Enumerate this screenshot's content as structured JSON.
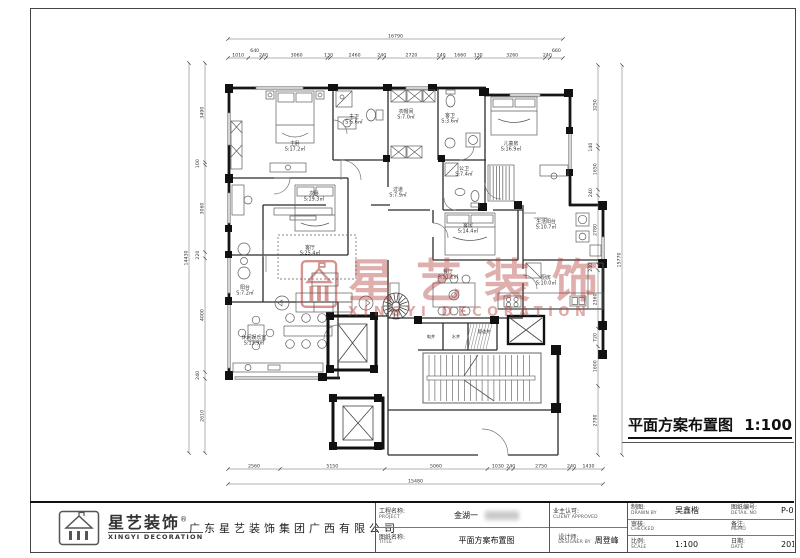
{
  "drawing": {
    "plan_title": "平面方案布置图",
    "plan_scale": "1:100",
    "watermark": {
      "cn": "星艺装饰",
      "en": "XINGYI DECORATION"
    },
    "rooms": [
      {
        "name": "主卧",
        "area": "S:17.2㎡",
        "x": 117,
        "y": 120
      },
      {
        "name": "主卫",
        "area": "S:5.6㎡",
        "x": 176,
        "y": 93
      },
      {
        "name": "衣帽间",
        "area": "S:7.0㎡",
        "x": 228,
        "y": 88
      },
      {
        "name": "客卫",
        "area": "S:3.6㎡",
        "x": 272,
        "y": 92
      },
      {
        "name": "儿童房",
        "area": "S:16.9㎡",
        "x": 333,
        "y": 120
      },
      {
        "name": "次卧",
        "area": "S:19.3㎡",
        "x": 136,
        "y": 170
      },
      {
        "name": "过道",
        "area": "S:7.9㎡",
        "x": 220,
        "y": 166
      },
      {
        "name": "公卫",
        "area": "S:7.4㎡",
        "x": 286,
        "y": 145
      },
      {
        "name": "客厅",
        "area": "S:25.4㎡",
        "x": 132,
        "y": 224
      },
      {
        "name": "客房",
        "area": "S:14.4㎡",
        "x": 290,
        "y": 202
      },
      {
        "name": "生活阳台",
        "area": "S:10.7㎡",
        "x": 368,
        "y": 198
      },
      {
        "name": "餐厅",
        "area": "S:11.1㎡",
        "x": 270,
        "y": 248
      },
      {
        "name": "厨房",
        "area": "S:10.0㎡",
        "x": 368,
        "y": 254
      },
      {
        "name": "阳台",
        "area": "S:7.2㎡",
        "x": 67,
        "y": 264
      },
      {
        "name": "休闲娱乐室",
        "area": "S:13.9㎡",
        "x": 76,
        "y": 314
      }
    ],
    "core_labels": [
      {
        "text": "电井",
        "x": 253,
        "y": 313
      },
      {
        "text": "水井",
        "x": 278,
        "y": 313
      },
      {
        "text": "管道井",
        "x": 306,
        "y": 308
      }
    ],
    "dims": {
      "top": {
        "total": "16790",
        "segments": [
          "1010",
          "640",
          "240",
          "3060",
          "130",
          "2460",
          "240",
          "2720",
          "240",
          "1660",
          "130",
          "3260",
          "240",
          "660"
        ]
      },
      "bottom": {
        "total": "15480",
        "segments": [
          "2560",
          "5150",
          "5060",
          "1030",
          "240",
          "2750",
          "240",
          "1430"
        ]
      },
      "left": {
        "total": "14430",
        "segments": [
          "3490",
          "100",
          "3060",
          "220",
          "4000",
          "240",
          "2610"
        ]
      },
      "right": {
        "total": "15770",
        "segments": [
          "3250",
          "140",
          "1650",
          "240",
          "2780",
          "240",
          "2360",
          "720",
          "1600",
          "2790"
        ]
      }
    }
  },
  "title_block": {
    "logo": {
      "cn": "星艺装饰",
      "reg": "®",
      "en": "XINGYI DECORATION"
    },
    "company": "广东星艺装饰集团广西有限公司",
    "fields": {
      "project_label": "工程名称:",
      "project_label_en": "PROJECT",
      "project_value": "金湖一",
      "title_label": "图纸名称:",
      "title_label_en": "TITLE",
      "title_value": "平面方案布置图",
      "client_label": "业主认可:",
      "client_label_en": "CLIENT APPROVED",
      "client_value": "",
      "designer_label": "设计师:",
      "designer_label_en": "DESIGNER BY",
      "designer_value": "周登峰",
      "drawn_label": "制图:",
      "drawn_label_en": "DRAWN BY",
      "drawn_value": "吴鑫楷",
      "detail_label": "图纸编号:",
      "detail_label_en": "DETAIL NO",
      "detail_value": "P-03",
      "checked_label": "审核:",
      "checked_label_en": "CHECKED",
      "checked_value": "",
      "memo_label": "备注:",
      "memo_label_en": "MEMO",
      "memo_value": "",
      "scale_label": "比例:",
      "scale_label_en": "SCALE",
      "scale_value": "1:100",
      "date_label": "日期:",
      "date_label_en": "DATE",
      "date_value": "2016-07-15"
    }
  },
  "colors": {
    "watermark": "#b23e38",
    "wall": "#161616",
    "line": "#666666"
  }
}
